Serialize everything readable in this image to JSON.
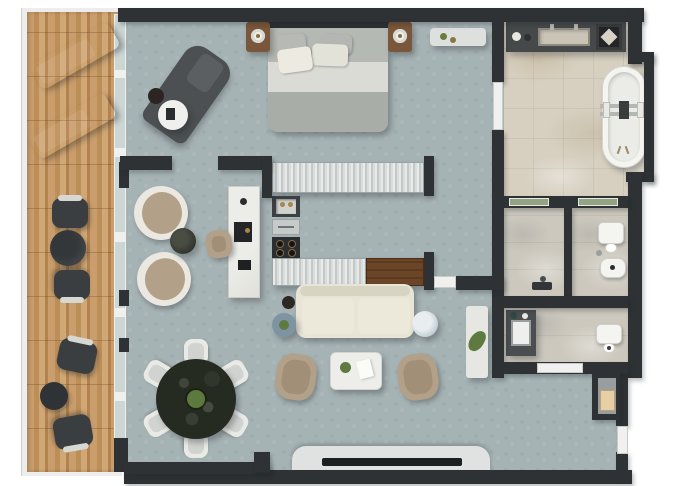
{
  "meta": {
    "title": "Apartment floor plan — top-down 3D render",
    "view": "top-down",
    "style": "photorealistic architectural render"
  },
  "palette": {
    "wall": "#2e3234",
    "floor": "#a6b3b5",
    "marble": "#d7d0c1",
    "marble2": "#ccc8bd",
    "glass": "#ccd7d5",
    "glassgreen": "#93a383",
    "frame": "#f0f1ef",
    "charcoal": "#53575８",
    "darkfurn": "#3a3e40",
    "tan": "#b2a088",
    "cream": "#e8e4d6",
    "wood2": "#7a573a",
    "brass": "#a98548",
    "green": "#5f7a41",
    "tv": "#1d2022",
    "bluetable": "#7f94a2"
  },
  "rooms": {
    "balcony": "Balcony / terrace (wood deck)",
    "bedroom": "Bedroom",
    "sitting": "Sitting area",
    "kitchen": "Galley kitchen",
    "living": "Living room",
    "dining": "Dining area",
    "corridor": "Corridor",
    "bathroom": "Master bathroom",
    "shower": "Shower room",
    "wc": "WC (toilet + bidet)",
    "laundry": "Guest bath / laundry",
    "entry": "Entry hall"
  },
  "furniture": {
    "lounger": "Sun lounger",
    "bistro": "Balcony bistro set",
    "bed": "Double bed with pillows",
    "nightstand": "Nightstand with lamp",
    "bench": "Bedroom bench",
    "chaise": "Chaise lounge",
    "island": "Kitchen island / desk",
    "counter_top": "Kitchen counter (north run)",
    "counter_bottom": "Kitchen counter (south run)",
    "sink": "Kitchen sink",
    "cooktop": "4-burner cooktop",
    "armchairs": "Pair of round armchairs",
    "sofa": "Cream sofa",
    "coffee_table": "Coffee table",
    "tv_console": "TV console with television",
    "dining_table": "Round dining table with 6 chairs",
    "console_plant": "Console with plant",
    "vanity": "Bathroom vanity with trough sink",
    "bathtub": "Freestanding bathtub",
    "shower_fixture": "Shower fixture",
    "toilet": "Toilet",
    "bidet": "Bidet",
    "laundry_counter": "Utility counter with sink",
    "niche_cabinet": "Hall niche cabinet",
    "entry_door": "Entry door"
  }
}
